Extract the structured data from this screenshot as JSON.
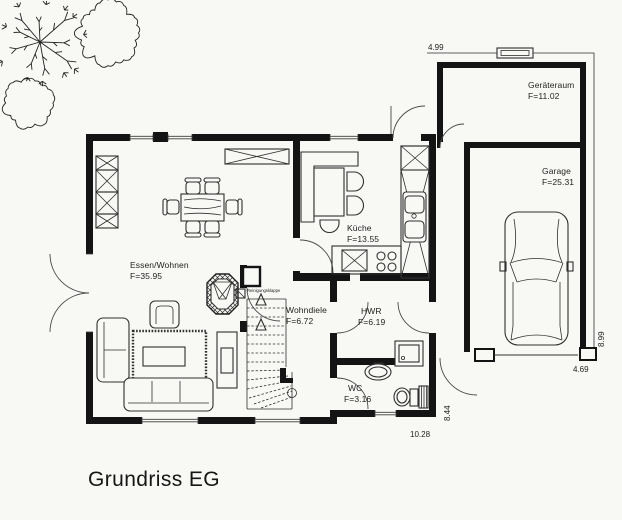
{
  "title": "Grundriss EG",
  "rooms": [
    {
      "name": "Essen/Wohnen",
      "area": "F=35.95"
    },
    {
      "name": "Küche",
      "area": "F=13.55"
    },
    {
      "name": "Wohndiele",
      "area": "F=6.72"
    },
    {
      "name": "HWR",
      "area": "F=6.19"
    },
    {
      "name": "WC",
      "area": "F=3.16"
    },
    {
      "name": "Geräteraum",
      "area": "F=11.02"
    },
    {
      "name": "Garage",
      "area": "F=25.31"
    }
  ],
  "annotations": {
    "chimney_hatch": "Reinigungsklappe"
  },
  "dimensions": {
    "top": "4.99",
    "garage_right": "8.99",
    "garage_bottom": "4.69",
    "house_right": "8.44",
    "house_bottom": "10.28"
  },
  "colors": {
    "wall": "#141414",
    "line": "#2f2f2f",
    "text": "#222222",
    "background": "#f8f8f5"
  }
}
